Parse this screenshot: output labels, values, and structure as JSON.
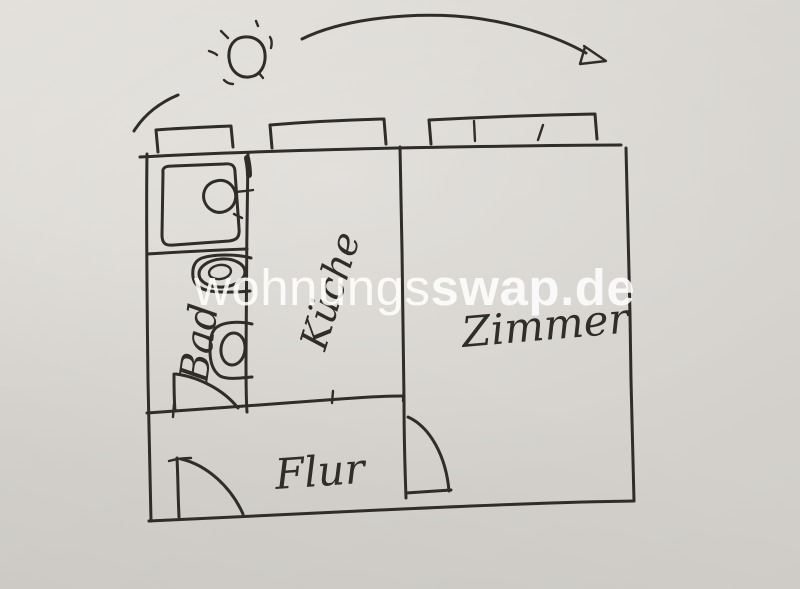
{
  "colors": {
    "paper": "#d8d5d0",
    "paper-light": "#e2dfda",
    "paper-dark": "#d1cec9",
    "ink": "#302d29",
    "watermark": "#ffffff"
  },
  "watermark": {
    "regular": "wohnungs",
    "bold": "swap.de",
    "full": "wohnungsswap.de"
  },
  "rooms": [
    {
      "id": "bad",
      "label": "Bad"
    },
    {
      "id": "kueche",
      "label": "Küche"
    },
    {
      "id": "zimmer",
      "label": "Zimmer"
    },
    {
      "id": "flur",
      "label": "Flur"
    }
  ],
  "icons": {
    "sun": "sun-icon",
    "direction_arrow": "arrow-icon"
  }
}
